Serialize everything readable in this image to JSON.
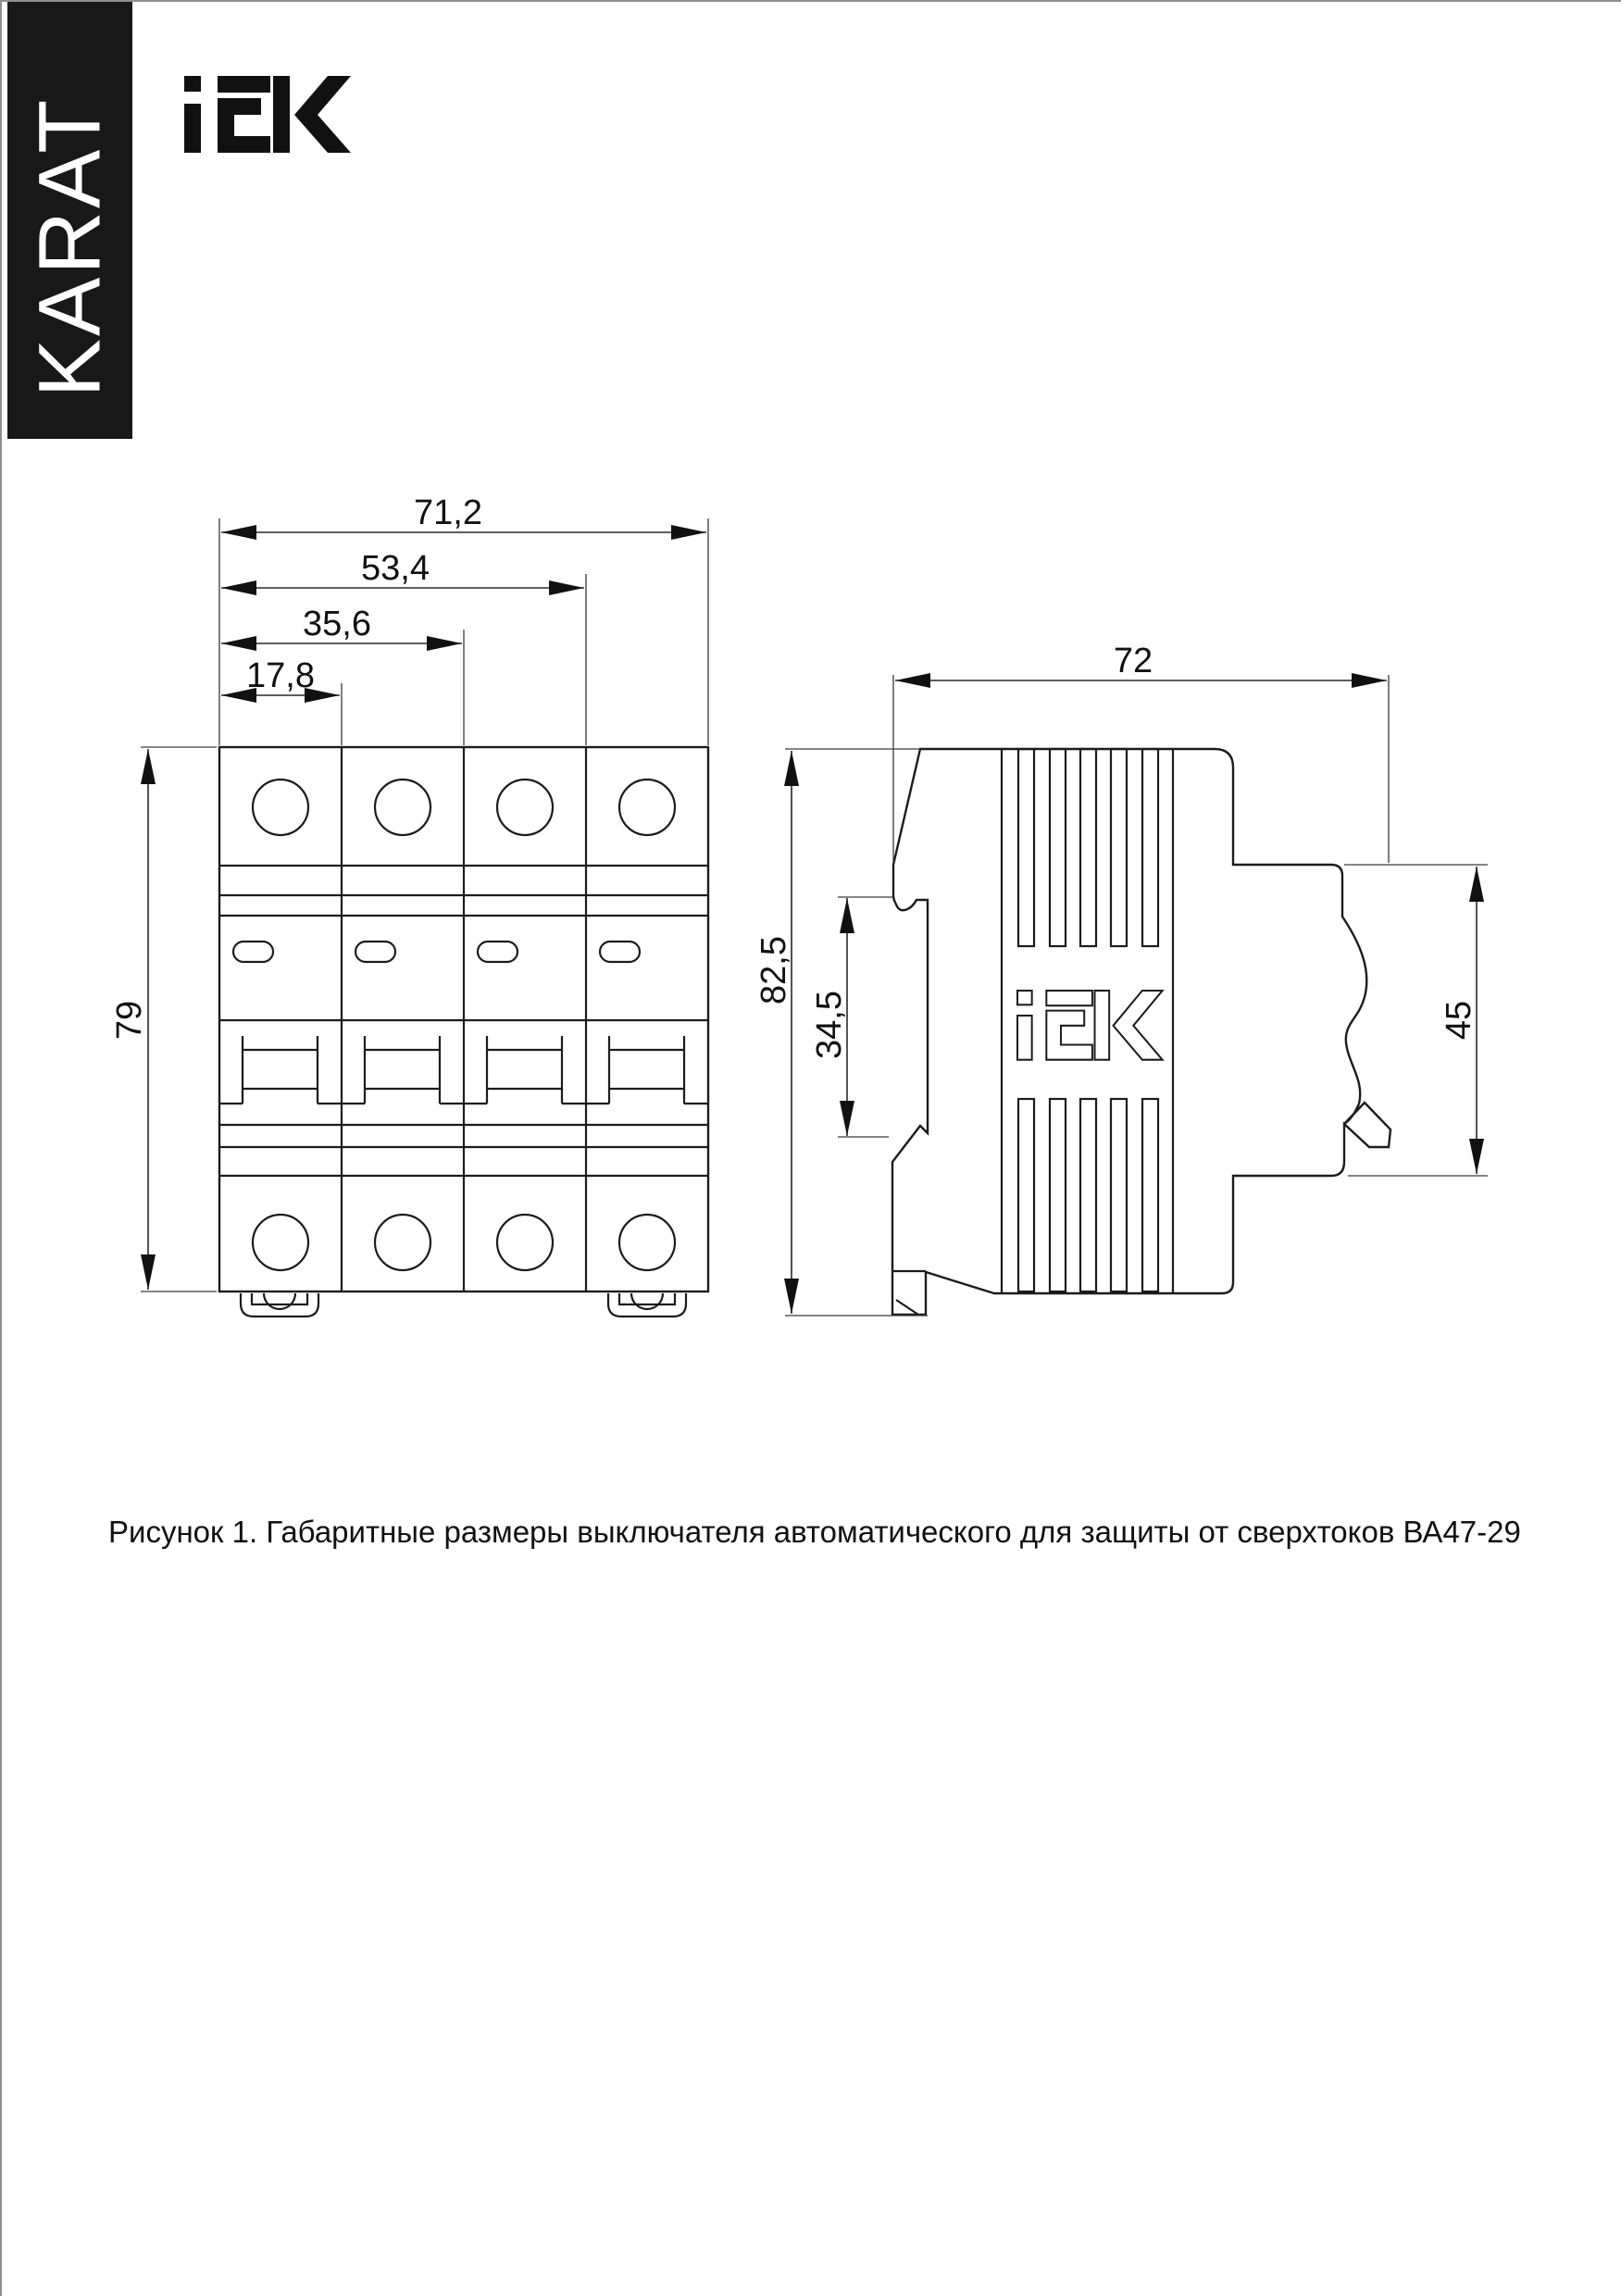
{
  "brand": {
    "karat_label": "KARAT",
    "iek_logo_alt": "IEK"
  },
  "figure": {
    "caption": "Рисунок 1. Габаритные размеры выключателя автоматического для защиты от сверхтоков ВА47-29"
  },
  "front_view": {
    "width_total": "71,2",
    "width_three_modules": "53,4",
    "width_two_modules": "35,6",
    "width_one_module": "17,8",
    "height": "79"
  },
  "side_view": {
    "depth": "72",
    "height_total": "82,5",
    "din_recess_height": "34,5",
    "front_face_height": "45"
  },
  "colors": {
    "line": "#1c1c1c",
    "banner_bg": "#181818"
  }
}
